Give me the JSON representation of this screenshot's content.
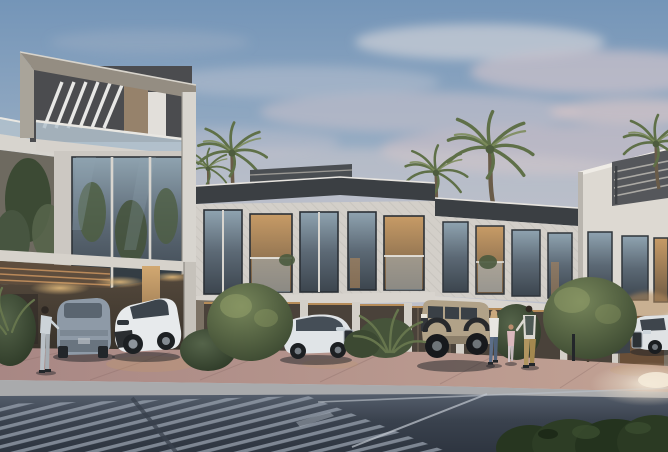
{
  "scene": {
    "type": "architectural_exterior_render",
    "setting": "modern townhouse complex at dusk",
    "description": "Photorealistic real-estate rendering: a row of white two-storey townhouses with a three-storey corner tower, covered parking with several cars, palm trees, shrubs, four pedestrians, and a foreground asphalt road with a zebra crosswalk under a pink-tinted dusk sky",
    "time_of_day": "dusk",
    "weather": "clear, soft pink clouds"
  },
  "colors": {
    "sky_top": "#7495b8",
    "sky_horizon": "#d6ccce",
    "cloud_pink": "#d2c2c8",
    "building_white": "#d3cfc9",
    "building_right": "#ddd9d2",
    "tower_fascia": "#948d82",
    "roof_dark": "#3b3f43",
    "glass_dark": "#4a545c",
    "glass_reflection": "#8fa3b0",
    "warm_light": "#d2a35f",
    "paver_pink": "#b08e88",
    "sidewalk_gray": "#a9aaac",
    "road_dark": "#353d49",
    "crosswalk_stripe": "#97a0ad",
    "road_line_white": "#bfc6ce",
    "vegetation_green": "#5a6b4a",
    "hedge_dark": "#26351f",
    "palm_green": "#5f7048",
    "car_suv_gray": "#8e9aa7",
    "car_chr_white": "#e7eaec",
    "car_audi_white": "#e0e4e7",
    "car_hummer_tan": "#b1a288",
    "car_dark": "#3d434a",
    "car_right_white": "#dfe2e4"
  },
  "buildings": {
    "tower": {
      "storeys": 3,
      "features": [
        "rooftop pergola with white diagonal slats",
        "glass balustrade terrace",
        "full-height tinted glazing with tree reflections",
        "white fascia frame"
      ]
    },
    "row_blocks": {
      "count": 3,
      "storeys": 2,
      "features": [
        "dark flat roof overhangs",
        "textured white cladding",
        "floor-to-ceiling windows",
        "glass balconies with plants",
        "warm interior lighting",
        "covered parking bays with downlights"
      ]
    }
  },
  "vehicles": [
    {
      "kind": "suv",
      "color": "grey-blue",
      "view": "rear",
      "position": "left carport"
    },
    {
      "kind": "crossover",
      "color": "white",
      "view": "front three-quarter",
      "position": "left carport"
    },
    {
      "kind": "suv",
      "color": "white",
      "view": "side facing right",
      "position": "centre"
    },
    {
      "kind": "off-road truck",
      "color": "sand",
      "view": "front three-quarter facing left",
      "position": "centre-right"
    },
    {
      "kind": "car",
      "color": "dark grey",
      "view": "partially hidden behind shrub",
      "position": "right"
    },
    {
      "kind": "suv",
      "color": "white",
      "view": "front facing left",
      "position": "far right"
    }
  ],
  "people": [
    {
      "role": "adult",
      "clothing": "light top, pale trousers",
      "action": "standing beside grey SUV",
      "position": "left"
    },
    {
      "role": "woman",
      "clothing": "white top, blue jeans",
      "action": "walking",
      "position": "centre-right"
    },
    {
      "role": "child",
      "clothing": "pink outfit",
      "action": "walking between adults",
      "position": "centre-right"
    },
    {
      "role": "man",
      "clothing": "light shirt, dark vest, khaki trousers",
      "action": "walking",
      "position": "centre-right"
    }
  ],
  "vegetation": {
    "palm_trees": 5,
    "shrubs": 6,
    "foreground_hedge": true
  },
  "road": {
    "markings": [
      "zebra crosswalk bottom-left",
      "white lane lines on the right",
      "kerb line"
    ],
    "sidewalk": "grey kerb band with pink paver apron in front of the houses"
  }
}
